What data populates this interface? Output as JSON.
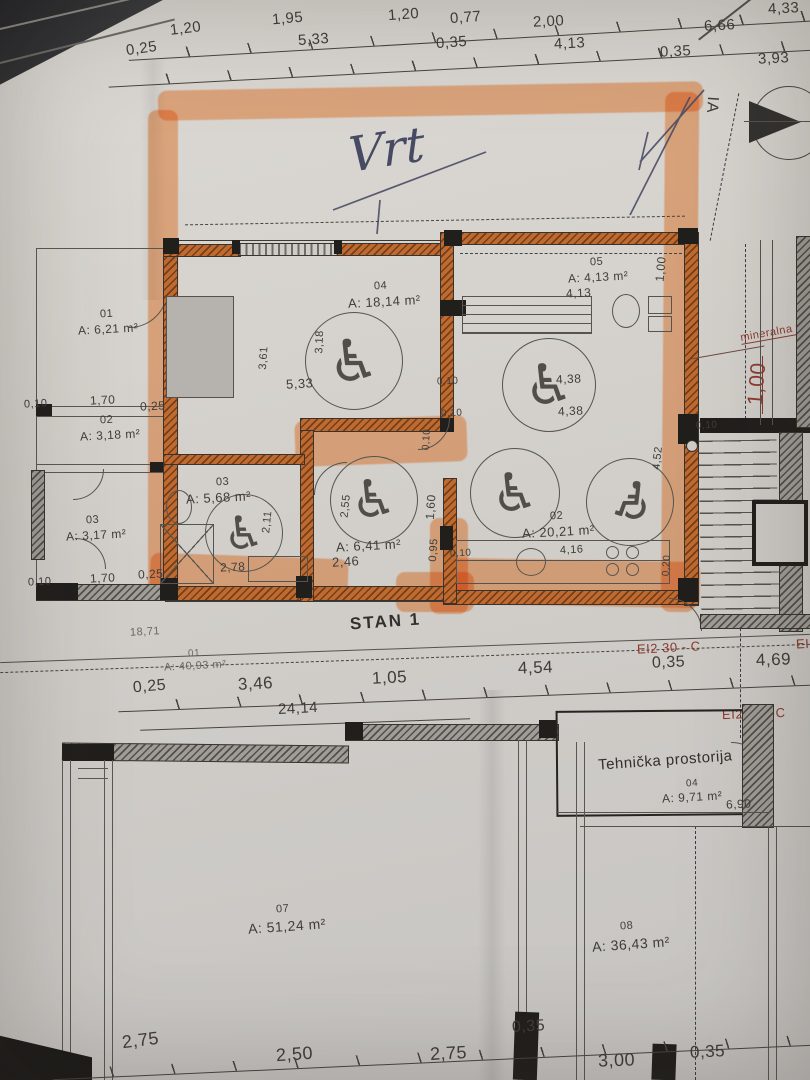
{
  "photo": {
    "handwriting": "Vrt",
    "section_label": "IA",
    "unit_label": "STAN 1",
    "fire_label_1": "EI2 30 - C",
    "fire_label_2": "EI2 30 - C",
    "fire_label_3": "EI2",
    "material_note": "mineralna vu",
    "material_dim": "1,00"
  },
  "rooms": {
    "a01": {
      "num": "01",
      "area": "A: 6,21 m²"
    },
    "a02": {
      "num": "02",
      "area": "A: 3,18 m²"
    },
    "a03": {
      "num": "03",
      "area": "A: 3,17 m²"
    },
    "r04": {
      "num": "04",
      "area": "A: 18,14 m²"
    },
    "r05": {
      "num": "05",
      "area": "A: 4,13 m²"
    },
    "r03": {
      "num": "03",
      "area": "A: 5,68 m²"
    },
    "hall": {
      "area": "A: 6,41 m²"
    },
    "r02": {
      "num": "02",
      "area": "A: 20,21 m²"
    },
    "stan": {
      "num": "01",
      "area": "A: 40,93 m²"
    },
    "teh": {
      "name": "Tehnička prostorija",
      "num": "04",
      "area": "A: 9,71 m²"
    },
    "r07": {
      "num": "07",
      "area": "A: 51,24 m²"
    },
    "r08": {
      "num": "08",
      "area": "A: 36,43 m²"
    }
  },
  "dims": {
    "t1a": "1,20",
    "t1b": "1,95",
    "t1c": "1,20",
    "t1d": "0,77",
    "t1e": "2,00",
    "t1f": "4,33",
    "t1g": "6,66",
    "t2a": "0,25",
    "t2b": "5,33",
    "t2c": "0,35",
    "t2d": "4,13",
    "t2e": "0,35",
    "t2f": "3,93",
    "l1a": "0,10",
    "l1b": "1,70",
    "l1c": "0,25",
    "l2a": "0,10",
    "l2b": "1,70",
    "l2c": "0,25",
    "c1": "3,61",
    "c2": "3,18",
    "c3": "5,33",
    "c4": "4,13",
    "c5": "1,00",
    "c6": "0,10",
    "c7": "0,10",
    "c8": "1,60",
    "c9": "0,10",
    "b1": "2,11",
    "b2": "2,55",
    "b3": "2,78",
    "b4": "2,46",
    "b5": "0,95",
    "b6": "0,10",
    "k1": "4,38",
    "k2": "4,38",
    "k3": "4,16",
    "k4": "4,52",
    "k5": "0,20",
    "m1": "0,10",
    "s1": "18,71",
    "s2": "0,25",
    "s3": "3,46",
    "s4": "1,05",
    "s5": "4,54",
    "s6": "0,35",
    "s7": "4,69",
    "s8": "24,14",
    "th1": "6,90",
    "g1": "2,75",
    "g2": "2,50",
    "g3": "2,75",
    "g4": "0,35",
    "g5": "3,00",
    "g6": "0,35"
  },
  "colors": {
    "highlighter": "#ff8f3f",
    "fire_red": "#8e3a2f",
    "pen_blue": "#474a63",
    "wall_hatch": "#c06a2f"
  }
}
